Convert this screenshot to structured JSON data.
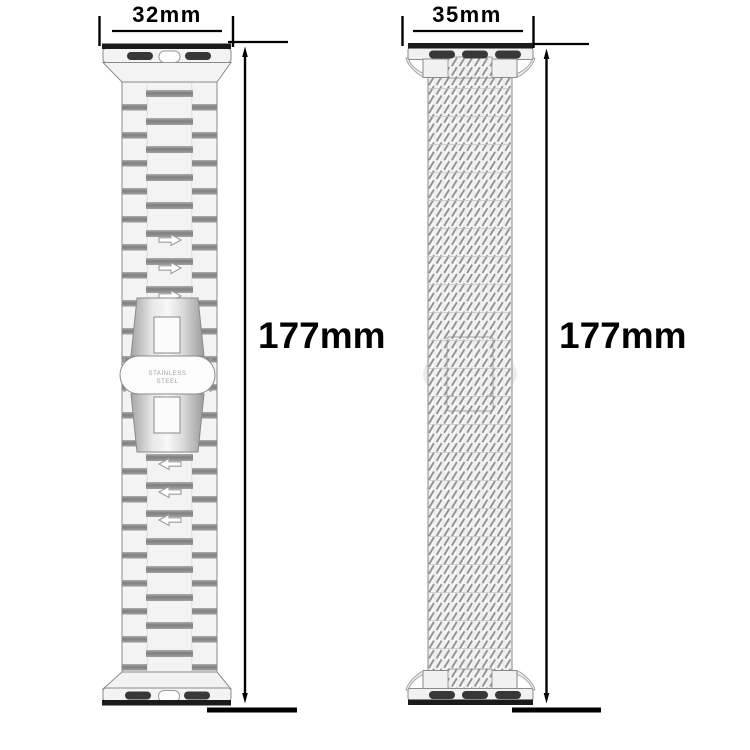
{
  "product": {
    "left_band": {
      "name": "stainless-steel-link-band",
      "width_label": "32mm",
      "length_label": "177mm",
      "engraving_line1": "STAINLESS",
      "engraving_line2": "STEEL"
    },
    "right_band": {
      "name": "woven-mesh-band",
      "width_label": "35mm",
      "length_label": "177mm"
    },
    "colors": {
      "background": "#ffffff",
      "dimension_lines": "#000000",
      "band_outline": "#8a8a8a",
      "connector_dark_bar": "#1b1b1b",
      "slot_dark": "#383838",
      "engraving_text": "#a0a0a0",
      "mesh_stroke": "#8f8f8f"
    }
  }
}
